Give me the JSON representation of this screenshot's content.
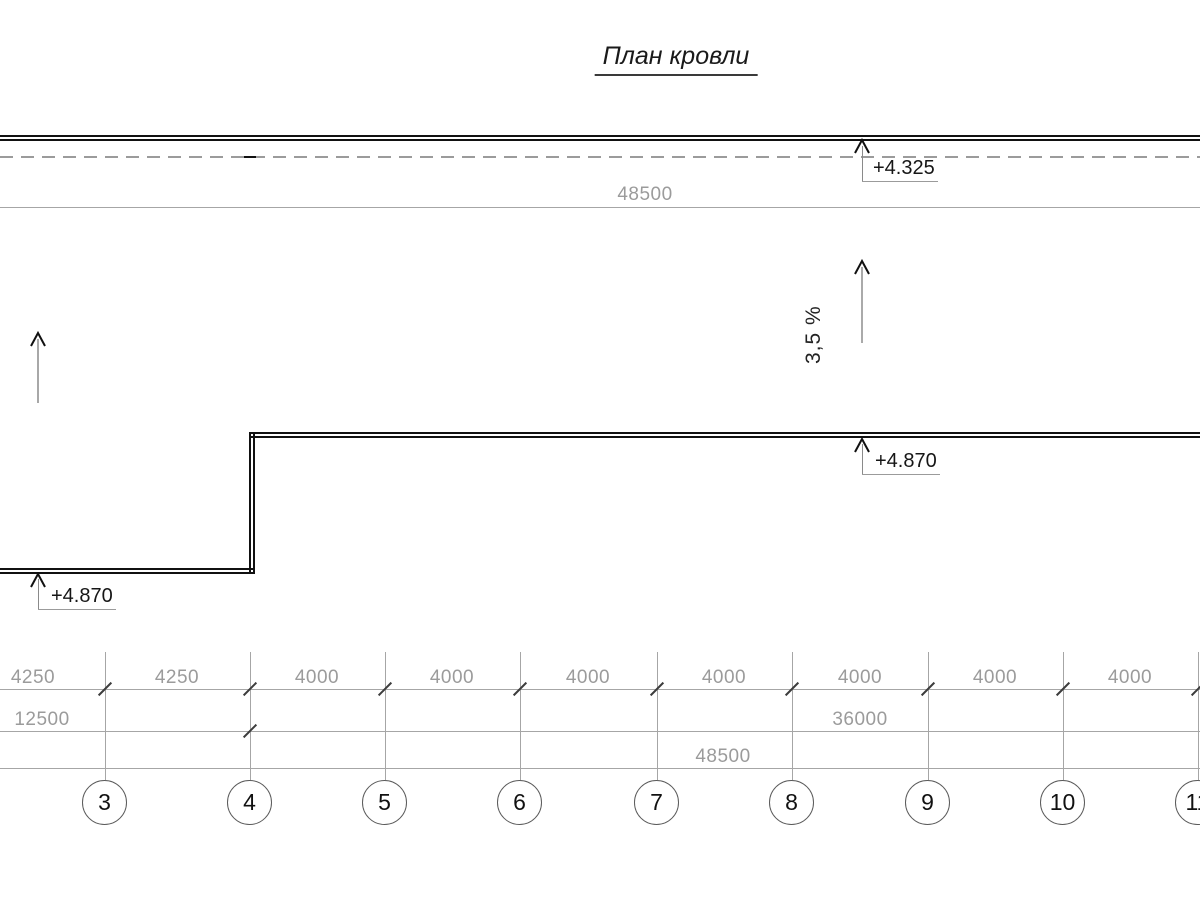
{
  "title": "План кровли",
  "colors": {
    "outline": "#111111",
    "dim_line": "#a6a6a6",
    "dim_text": "#9b9b9b",
    "dark_text": "#161616"
  },
  "top": {
    "elevation": "+4.325",
    "overall_dim": "48500"
  },
  "slopes": {
    "left": "3.5 %",
    "right": "3,5 %"
  },
  "roof": {
    "elevation_right": "+4.870",
    "elevation_left": "+4.870"
  },
  "dims": {
    "row1": [
      "4250",
      "4250",
      "4000",
      "4000",
      "4000",
      "4000",
      "4000",
      "4000",
      "4000"
    ],
    "row2": {
      "left": "12500",
      "right": "36000"
    },
    "row3": "48500"
  },
  "axes": [
    "3",
    "4",
    "5",
    "6",
    "7",
    "8",
    "9",
    "10",
    "11"
  ]
}
